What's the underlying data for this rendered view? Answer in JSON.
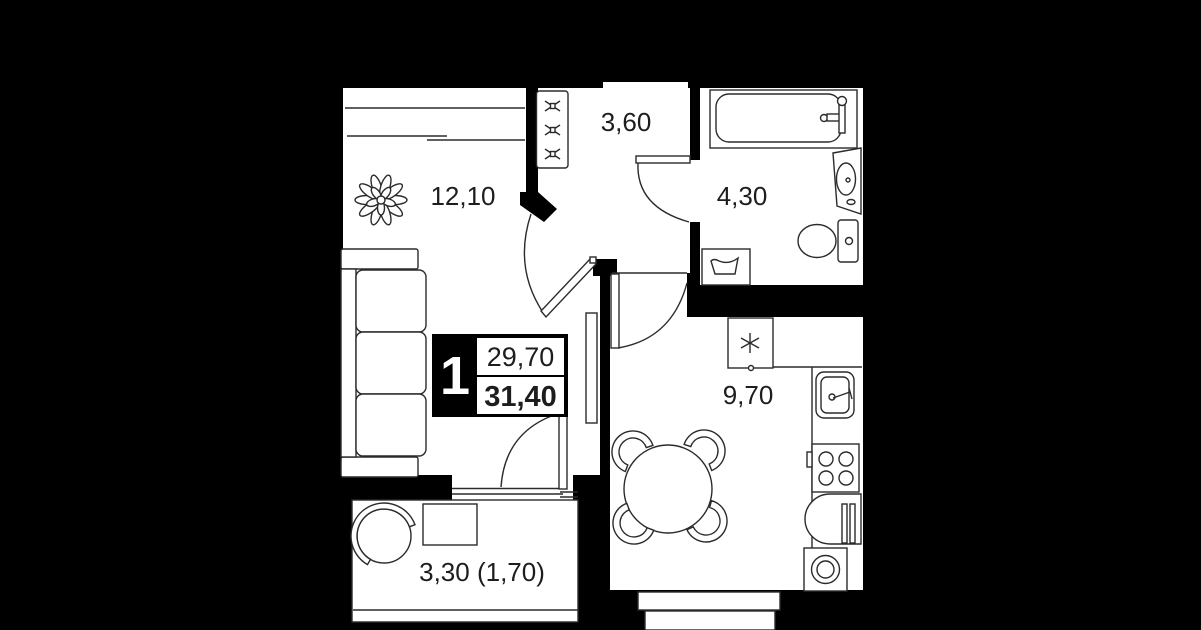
{
  "plan": {
    "unit_badge": {
      "rooms": "1",
      "living_area": "29,70",
      "total_area": "31,40"
    },
    "rooms": {
      "living": {
        "area": "12,10"
      },
      "hallway": {
        "area": "3,60"
      },
      "bathroom": {
        "area": "4,30"
      },
      "kitchen": {
        "area": "9,70"
      },
      "balcony": {
        "area": "3,30 (1,70)"
      }
    },
    "icons": [
      "wardrobe-hanger-icon",
      "fridge-asterisk-icon",
      "plant-icon"
    ],
    "colors": {
      "background": "#000000",
      "floor": "#ffffff",
      "wall": "#000000",
      "line": "#2b2b2b",
      "text": "#1d1d1f"
    }
  }
}
